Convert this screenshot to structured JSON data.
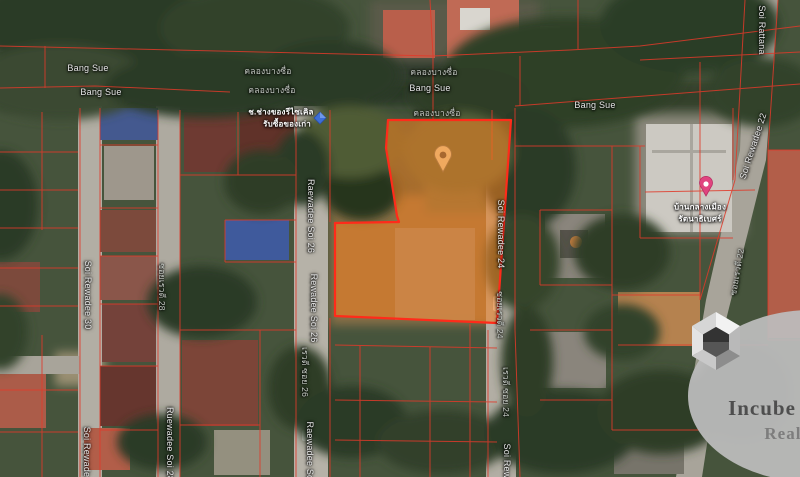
{
  "map": {
    "view": "satellite",
    "plot_fill": "#F58220",
    "plot_outline": "#FF2B1A",
    "parcel_line_color": "#E03A2A",
    "marker_color": "#F0A95F"
  },
  "street_labels": [
    {
      "text": "Bang Sue"
    },
    {
      "text": "Bang Sue"
    },
    {
      "text": "คลองบางซื่อ"
    },
    {
      "text": "คลองบางซื่อ"
    },
    {
      "text": "คลองบางซื่อ"
    },
    {
      "text": "Bang Sue"
    },
    {
      "text": "คลองบางซื่อ"
    },
    {
      "text": "Bang Sue"
    },
    {
      "text": "Soi Rattana"
    },
    {
      "text": "Soi Rewadee 22"
    },
    {
      "text": "ซอยเรวดี 22"
    },
    {
      "text": "Soi Rewadee 30"
    },
    {
      "text": "Soi Rewade"
    },
    {
      "text": "ซอยเรวดี 28"
    },
    {
      "text": "Ruewadee Soi 28"
    },
    {
      "text": "Raewadee Soi 26"
    },
    {
      "text": "Rewadee Soi 26"
    },
    {
      "text": "เรวดี ซอย 26"
    },
    {
      "text": "Raewadee Soi"
    },
    {
      "text": "Soi Rewadee 24"
    },
    {
      "text": "ซอยเรวดี 24"
    },
    {
      "text": "เรวดี ซอย 24"
    },
    {
      "text": "Soi Rew"
    }
  ],
  "poi": {
    "recycle": {
      "line1": "ช.ช่างของรีไซเคิล",
      "line2": "รับซื้อของเก่า"
    },
    "village": {
      "line1": "บ้านกลางเมือง",
      "line2": "รัตนาธิเบศร์"
    }
  },
  "watermark": {
    "brand": "Incube",
    "word": "Realty"
  }
}
